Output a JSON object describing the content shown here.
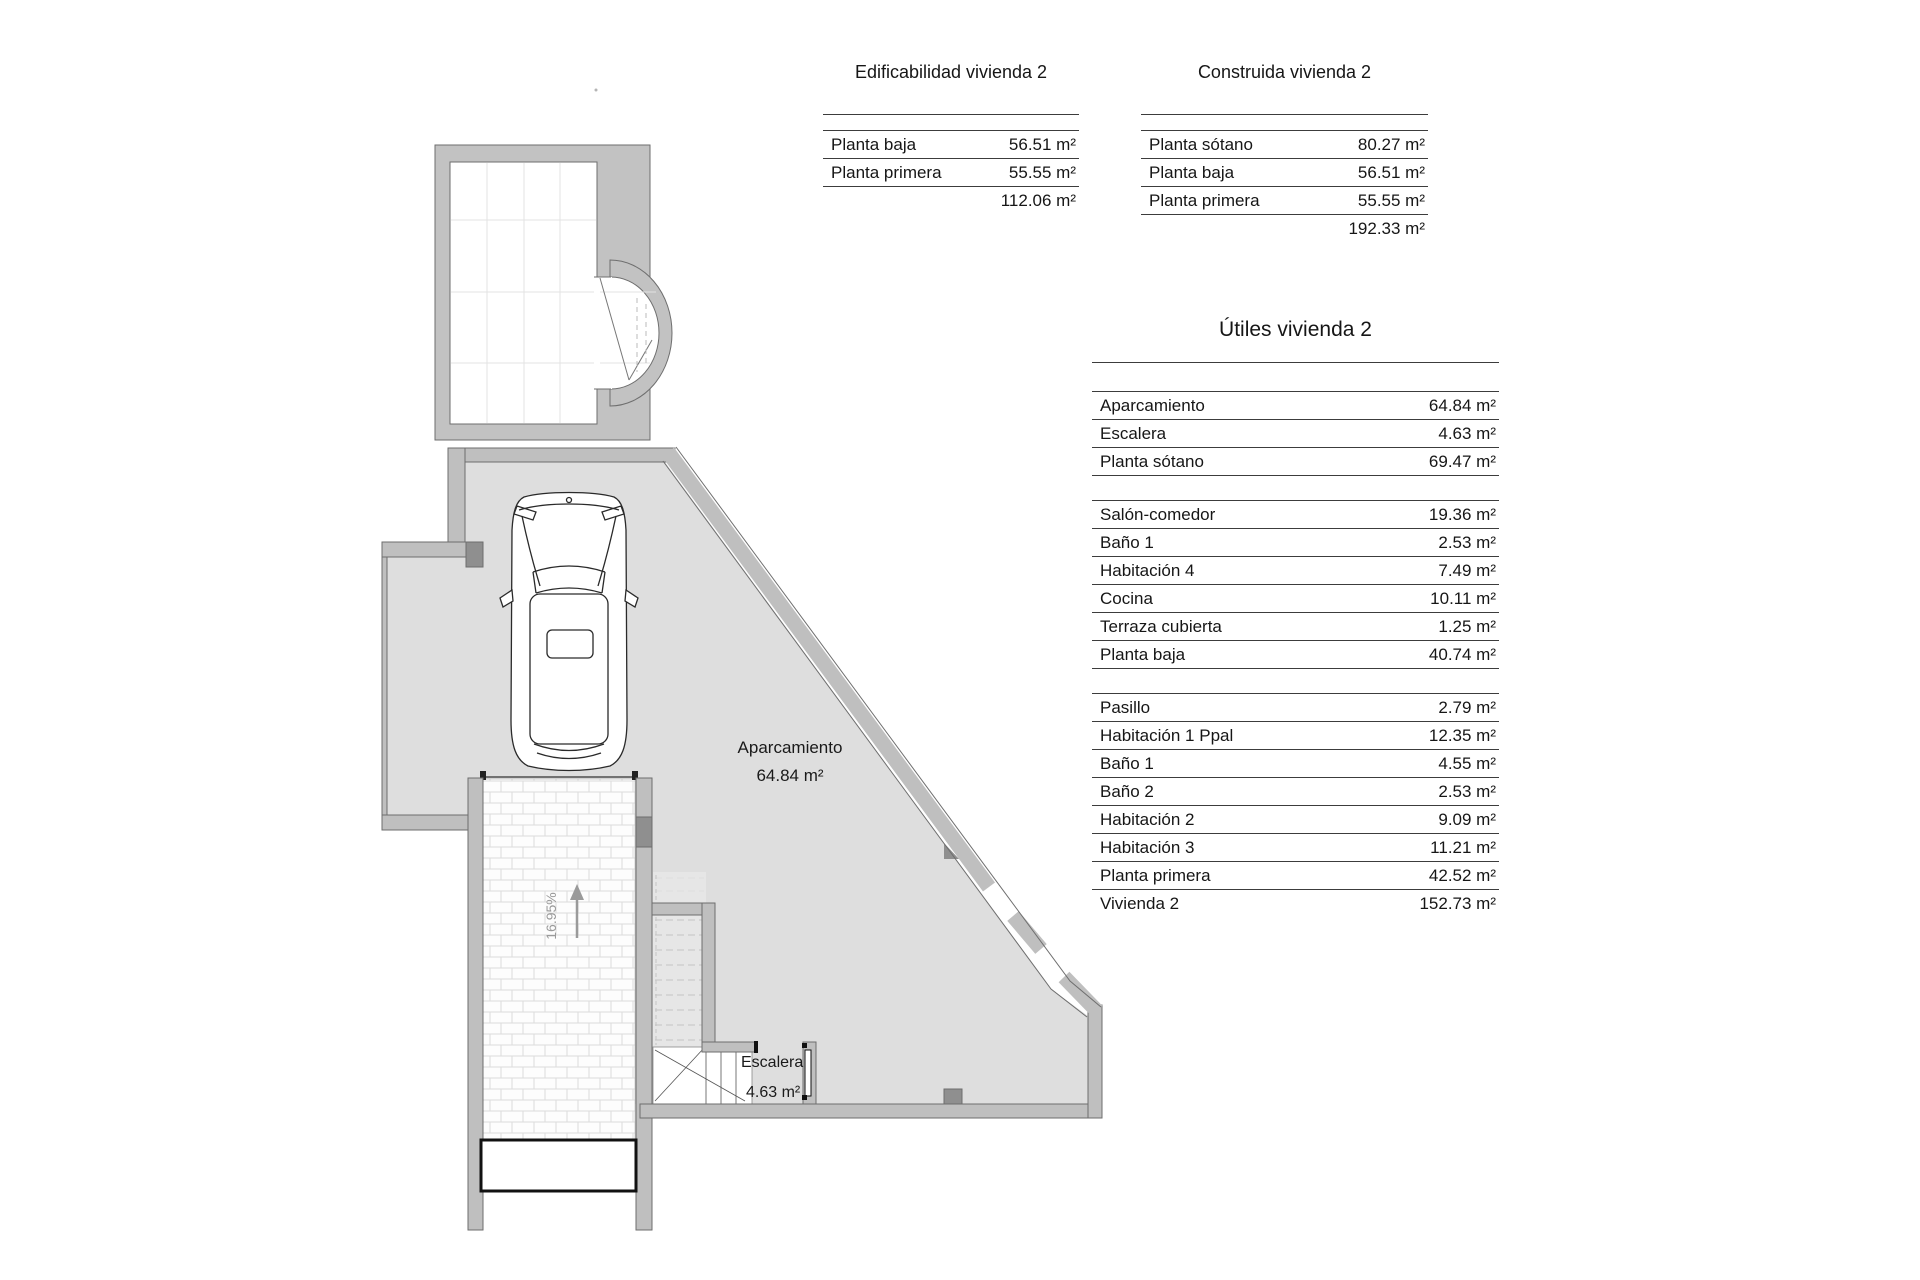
{
  "colors": {
    "wall_gray": "#bfbfbf",
    "wall_dark": "#8f8f8f",
    "wall_outline": "#6e6e6e",
    "floor_gray": "#dedede",
    "annotation_gray": "#9a9a9a",
    "line_black": "#3c3c3c"
  },
  "plan": {
    "labels": {
      "parking_name": "Aparcamiento",
      "parking_area": "64.84 m²",
      "stairs_name": "Escalera",
      "stairs_area": "4.63 m²",
      "ramp_slope": "16.95%"
    }
  },
  "tables": {
    "edificabilidad": {
      "title": "Edificabilidad vivienda 2",
      "rows": [
        {
          "label": "Planta baja",
          "value": "56.51 m²"
        },
        {
          "label": "Planta primera",
          "value": "55.55 m²"
        }
      ],
      "total": "112.06 m²"
    },
    "construida": {
      "title": "Construida vivienda 2",
      "rows": [
        {
          "label": "Planta sótano",
          "value": "80.27 m²"
        },
        {
          "label": "Planta baja",
          "value": "56.51 m²"
        },
        {
          "label": "Planta primera",
          "value": "55.55 m²"
        }
      ],
      "total": "192.33 m²"
    },
    "utiles": {
      "title": "Útiles vivienda 2",
      "groups": [
        {
          "rows": [
            {
              "label": "Aparcamiento",
              "value": "64.84 m²"
            },
            {
              "label": "Escalera",
              "value": "4.63 m²"
            },
            {
              "label": "Planta sótano",
              "value": "69.47 m²"
            }
          ]
        },
        {
          "rows": [
            {
              "label": "Salón-comedor",
              "value": "19.36 m²"
            },
            {
              "label": "Baño 1",
              "value": "2.53 m²"
            },
            {
              "label": "Habitación 4",
              "value": "7.49 m²"
            },
            {
              "label": "Cocina",
              "value": "10.11 m²"
            },
            {
              "label": "Terraza cubierta",
              "value": "1.25 m²"
            },
            {
              "label": "Planta baja",
              "value": "40.74 m²"
            }
          ]
        },
        {
          "rows": [
            {
              "label": "Pasillo",
              "value": "2.79 m²"
            },
            {
              "label": "Habitación 1 Ppal",
              "value": "12.35 m²"
            },
            {
              "label": "Baño 1",
              "value": "4.55 m²"
            },
            {
              "label": "Baño 2",
              "value": "2.53 m²"
            },
            {
              "label": "Habitación 2",
              "value": "9.09 m²"
            },
            {
              "label": "Habitación 3",
              "value": "11.21 m²"
            },
            {
              "label": "Planta primera",
              "value": "42.52 m²"
            },
            {
              "label": "Vivienda 2",
              "value": "152.73 m²"
            }
          ]
        }
      ]
    }
  }
}
